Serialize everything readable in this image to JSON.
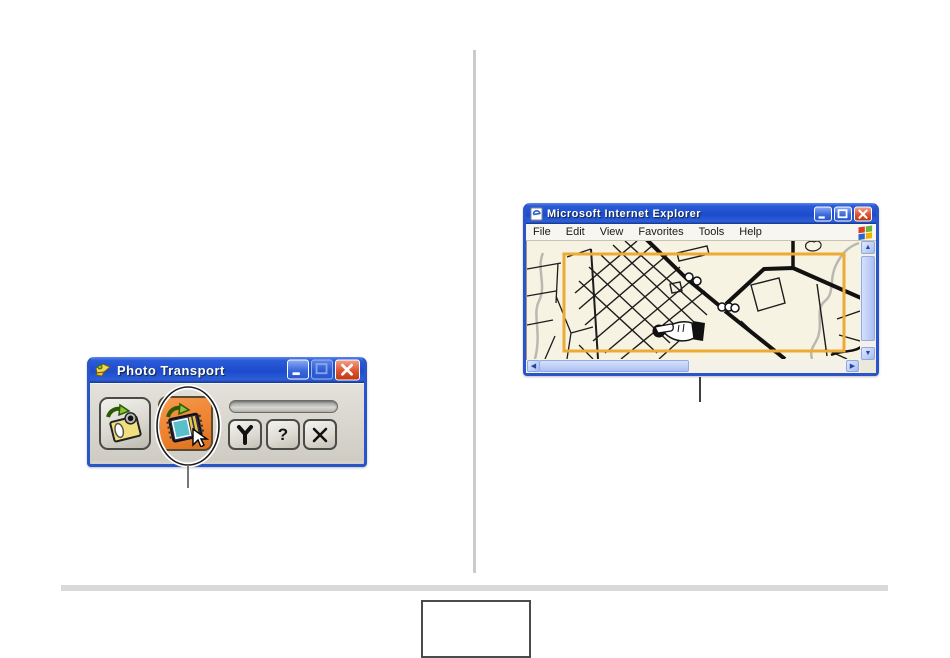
{
  "page": {
    "footer_rule": "horizontal-divider",
    "column_divider": "vertical-divider",
    "page_number_box_value": ""
  },
  "photo_transport": {
    "window_title": "Photo Transport",
    "titlebar_icon": "photo-transport-app-icon",
    "window_controls": [
      "minimize-icon",
      "maximize-icon",
      "close-icon"
    ],
    "toolbar": {
      "transfer_photos_button_icon": "camera-photo-arrow-icon",
      "album_button_icon": "photo-album-arrow-icon",
      "album_button_highlighted": true,
      "cursor": "mouse-pointer-icon"
    },
    "progress_bar_value": "",
    "settings_button_icon": "wrench-icon",
    "help_button_label": "?",
    "exit_button_icon": "x-icon",
    "annotation": "callout-circle-on-album-button"
  },
  "ie": {
    "window_title": "Microsoft Internet Explorer",
    "titlebar_icon": "ie-page-icon",
    "window_controls": [
      "minimize-icon",
      "maximize-icon",
      "close-icon"
    ],
    "menu": [
      "File",
      "Edit",
      "View",
      "Favorites",
      "Tools",
      "Help"
    ],
    "menubar_right_icon": "windows-flag-logo",
    "content": {
      "description": "street-map-drawing",
      "selection_rectangle": "orange-capture-frame",
      "pointer_annotation": "manicule-hand-icon",
      "scrollbars": [
        "vertical",
        "horizontal"
      ]
    },
    "annotation": "callout-line-below-window"
  },
  "colors": {
    "xp_titlebar_blue": "#2a5bd8",
    "window_border_blue": "#2a55c8",
    "chrome_gray": "#d5d1c9",
    "highlight_orange": "#ee8330",
    "selection_rect_orange": "#edaa35",
    "map_background": "#f6f3e3",
    "close_button_red": "#dd5330"
  }
}
